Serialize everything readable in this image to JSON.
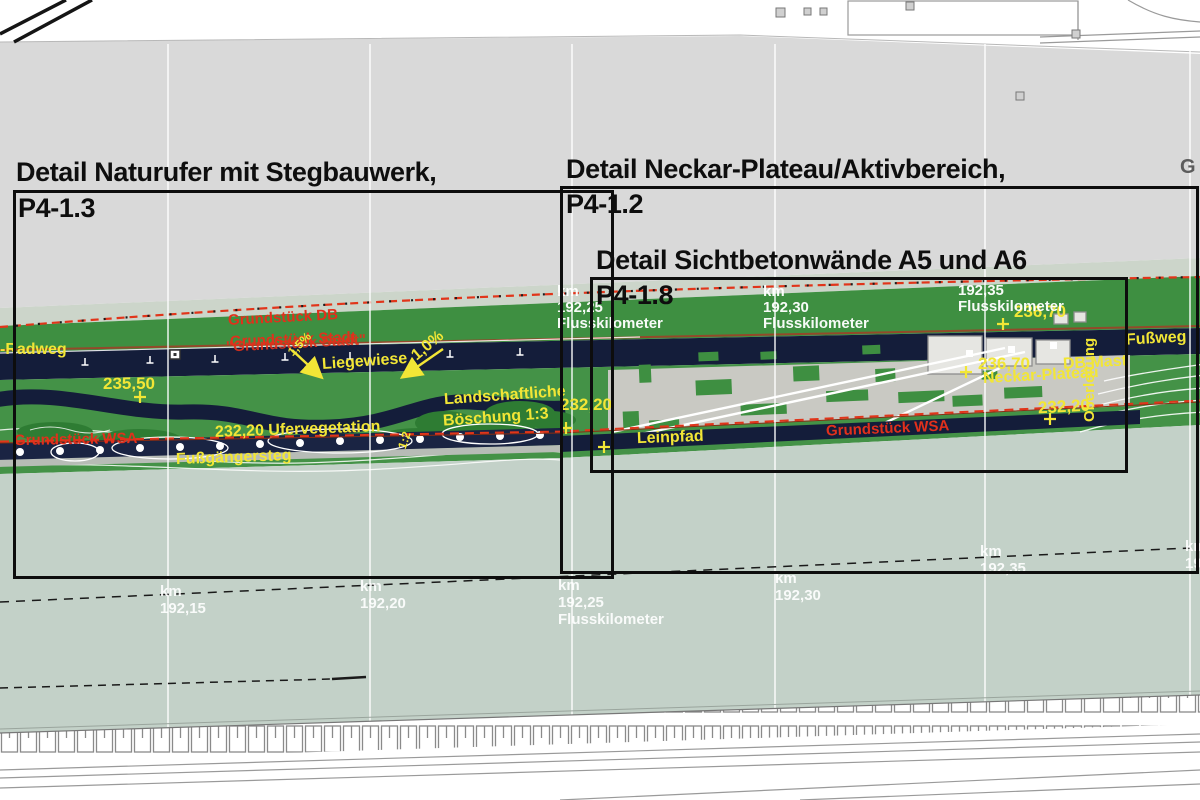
{
  "detail_boxes": [
    {
      "title": "Detail Naturufer mit Stegbauwerk,",
      "code": "P4-1.3"
    },
    {
      "title": "Detail Neckar-Plateau/Aktivbereich,",
      "code": "P4-1.2"
    },
    {
      "title": "Detail Sichtbetonwände A5 und A6",
      "code": "P4-1.8"
    }
  ],
  "property_labels": {
    "db": "Grundstück DB",
    "stadt": "Grundstück Stadt",
    "stadt_overlay": "\"Grundstück Stadt\"",
    "wsa_left": "Grundstück WSA",
    "wsa_right": "Grundstück WSA"
  },
  "feature_labels": {
    "radweg": "-Radweg",
    "liegewiese": "Liegewiese",
    "slope_a": "1,5%",
    "slope_b": "1,0%",
    "landschaftliche_1": "Landschaftliche",
    "landschaftliche_2": "Böschung 1:3",
    "ufervegetation": "232,20 Ufervegetation",
    "fussgaengersteg": "Fußgängersteg",
    "leinpfad": "Leinpfad",
    "neckar_plateau": "Neckar-Plateau",
    "db_mast": "DB Mast",
    "oberleitung": "Oberleitung",
    "fussweg": "Fußweg",
    "ratio_12": "1:2"
  },
  "elevations": {
    "e23550": "235,50",
    "e23220_mid": "232,20",
    "e23670_top": "236,70",
    "e23670_plateau": "236,70",
    "e23220_right": "232,20"
  },
  "km_markers_top": [
    {
      "prefix": "km",
      "value": "192,25",
      "label": "Flusskilometer"
    },
    {
      "prefix": "km",
      "value": "192,30",
      "label": "Flusskilometer"
    },
    {
      "prefix": "",
      "value": "192,35",
      "label": "Flusskilometer"
    }
  ],
  "km_markers_water": [
    {
      "prefix": "km",
      "value": "192,15",
      "label": ""
    },
    {
      "prefix": "km",
      "value": "192,20",
      "label": ""
    },
    {
      "prefix": "km",
      "value": "192,25",
      "label": "Flusskilometer"
    },
    {
      "prefix": "km",
      "value": "192,30",
      "label": ""
    },
    {
      "prefix": "km",
      "value": "192,35",
      "label": ""
    },
    {
      "prefix": "km",
      "value": "19",
      "label": ""
    }
  ],
  "misc": {
    "edge_letter": "G"
  },
  "colors": {
    "green": "#3e8f41",
    "navy": "#141d3a",
    "water": "#c3d1c8",
    "red_line": "#e1351a",
    "yellow": "#f2e636",
    "gray_band": "#d9d9d9",
    "sage": "#ccd5ca",
    "plateau": "#c9c9c3"
  }
}
